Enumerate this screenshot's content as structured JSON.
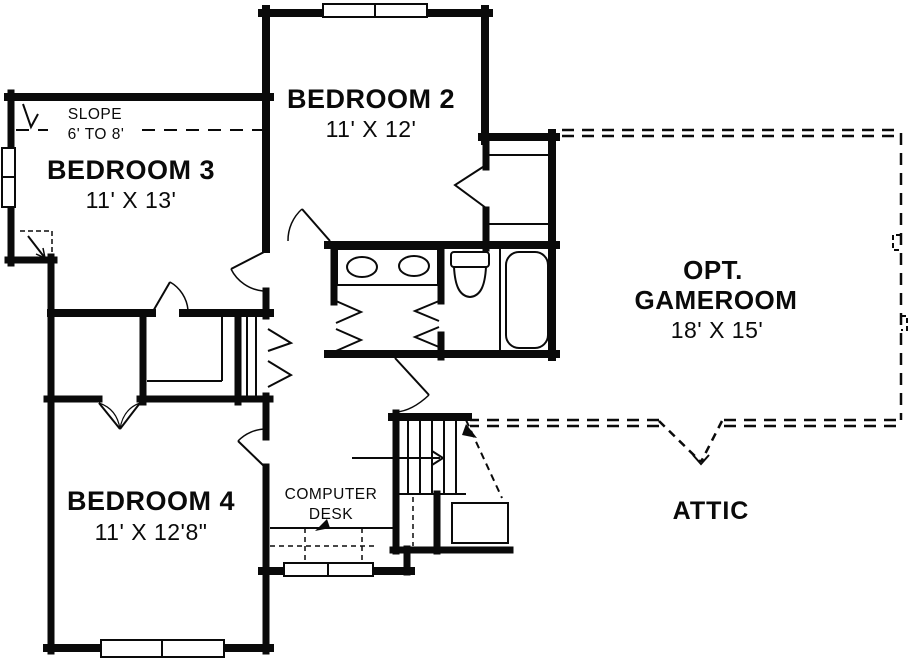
{
  "palette": {
    "ink": "#0a0a0a",
    "paper": "#ffffff"
  },
  "rooms": {
    "bedroom2": {
      "name": "BEDROOM 2",
      "dims": "11' X 12'"
    },
    "bedroom3": {
      "name": "BEDROOM 3",
      "dims": "11' X 13'"
    },
    "bedroom4": {
      "name": "BEDROOM 4",
      "dims": "11' X 12'8\""
    },
    "gameroom": {
      "prefix": "OPT.",
      "name": "GAMEROOM",
      "dims": "18' X 15'"
    },
    "attic": {
      "name": "ATTIC"
    }
  },
  "annotations": {
    "slope": {
      "line1": "SLOPE",
      "line2": "6' TO 8'"
    },
    "computer_desk": {
      "line1": "COMPUTER",
      "line2": "DESK"
    }
  },
  "fixtures": {
    "bathroom": [
      "double-vanity-sinks",
      "toilet",
      "bathtub"
    ],
    "circulation": [
      "staircase-up",
      "stair-rail",
      "attic-access-arrow"
    ],
    "storage": [
      "walk-in-closet-shelves",
      "linen-closet",
      "bedroom2-closet-shelves",
      "landing-cabinet"
    ],
    "windows": [
      "bedroom2-window",
      "bedroom3-window",
      "bedroom4-window",
      "computer-desk-window"
    ]
  }
}
